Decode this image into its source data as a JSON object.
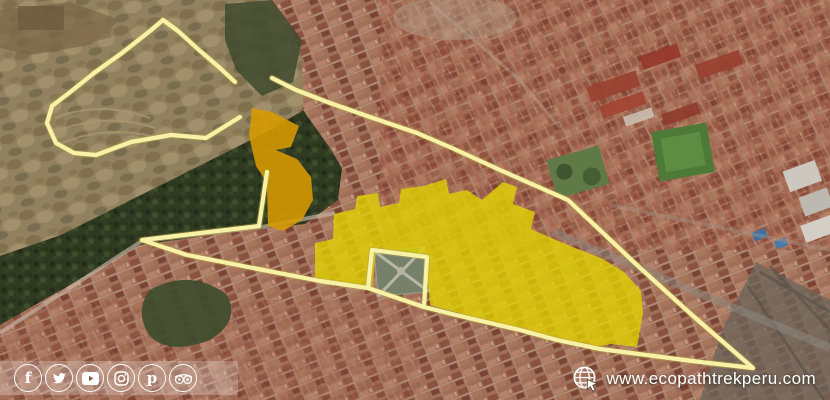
{
  "branding": {
    "website": "www.ecopathtrekperu.com",
    "globe_icon": "globe-with-cursor"
  },
  "social": {
    "icons": [
      {
        "name": "facebook"
      },
      {
        "name": "twitter"
      },
      {
        "name": "youtube"
      },
      {
        "name": "instagram"
      },
      {
        "name": "pinterest"
      },
      {
        "name": "tripadvisor"
      }
    ]
  },
  "map": {
    "type": "satellite-aerial-view",
    "overlays": {
      "route_outline_color": "#f8f2a8",
      "route_halo_color": "#b5a53f",
      "highlight_center_color": "#e3d400",
      "highlight_upper_color": "#d89b00"
    }
  }
}
